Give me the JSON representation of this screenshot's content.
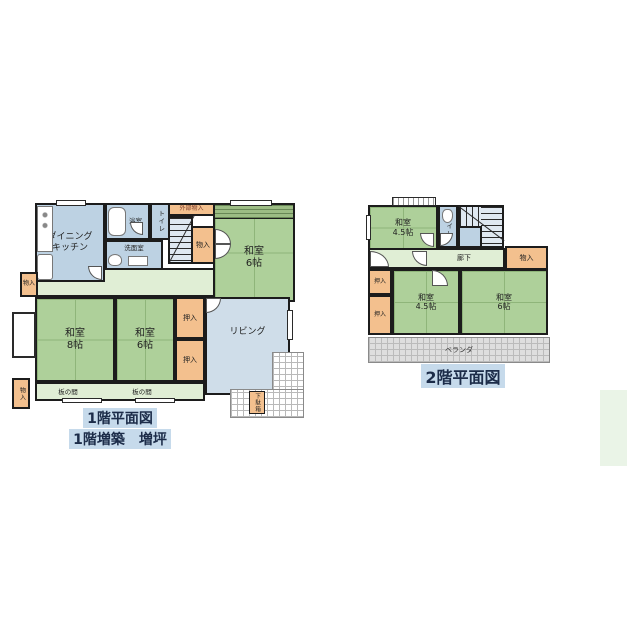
{
  "palette": {
    "tatami_green": "#aed09a",
    "wet_blue": "#bdd2e3",
    "living_blue": "#cfdde9",
    "hall_green": "#e0eed5",
    "closet_orange": "#f3c08e",
    "wall_black": "#1c1c1c",
    "caption_highlight": "#c6daeb",
    "veranda_gray": "#dedede",
    "side_rect_green": "#eaf4e7"
  },
  "floor1": {
    "caption": {
      "line1": "1階平面図",
      "line2": "1階増築　増坪"
    },
    "labels": {
      "dk": "ダイニング\nキッチン",
      "bath": "浴室",
      "toilet": "トイレ",
      "washroom": "洗面室",
      "ext_storage": "外部物入",
      "storage_stairs": "物入",
      "washitsu6_ne": "和室\n6帖",
      "storage_nw": "物入",
      "washitsu8": "和室\n8帖",
      "washitsu6_sw": "和室\n6帖",
      "oshiire_n": "押入",
      "oshiire_s": "押入",
      "living": "リビング",
      "itanoma_w": "板の間",
      "itanoma_e": "板の間",
      "storage_sw": "物入",
      "getabako": "下駄箱"
    }
  },
  "floor2": {
    "caption": "2階平面図",
    "labels": {
      "washitsu45_n": "和室\n4.5帖",
      "toilet": "トイレ",
      "hall": "廊下",
      "storage": "物入",
      "oshiire_n": "押入",
      "oshiire_s": "押入",
      "washitsu45_c": "和室\n4.5帖",
      "washitsu6": "和室\n6帖",
      "veranda": "ベランダ"
    }
  }
}
